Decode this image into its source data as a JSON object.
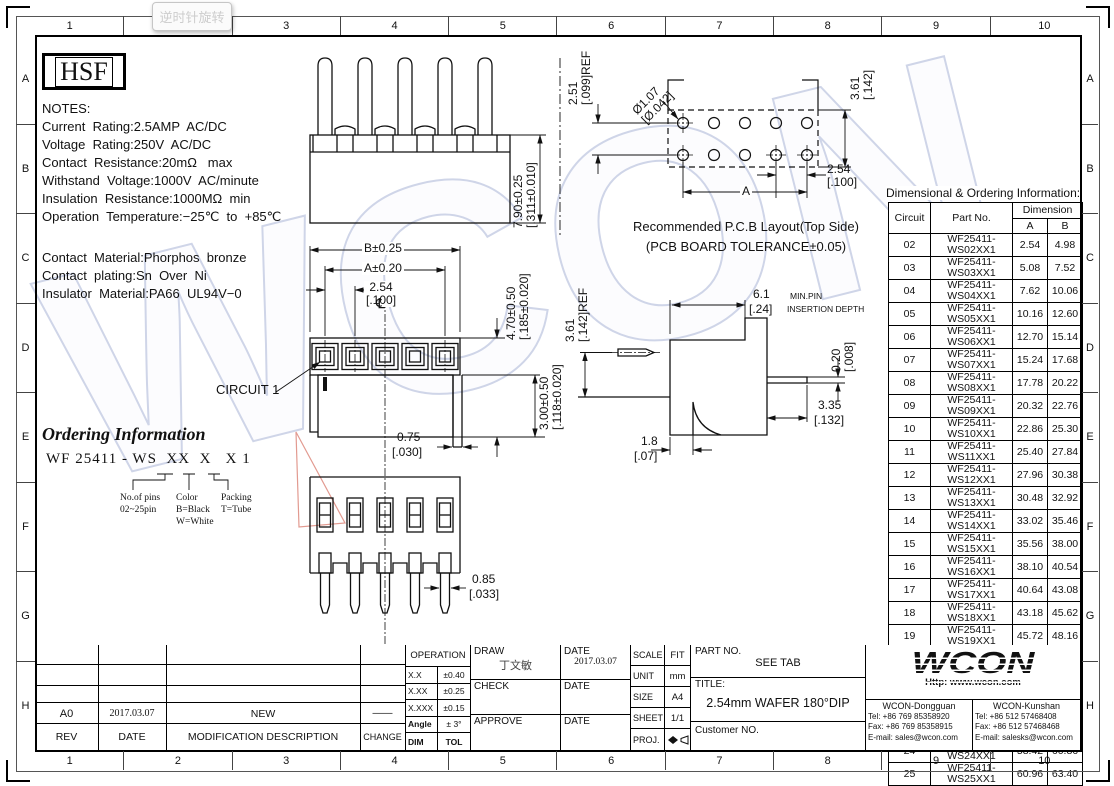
{
  "tooltip": {
    "label": "逆时针旋转"
  },
  "frame": {
    "cols": [
      "1",
      "2",
      "3",
      "4",
      "5",
      "6",
      "7",
      "8",
      "9",
      "10"
    ],
    "rows": [
      "A",
      "B",
      "C",
      "D",
      "E",
      "F",
      "G",
      "H"
    ]
  },
  "logo": {
    "text": "HSF"
  },
  "notes": {
    "lines": [
      "NOTES:",
      "Current  Rating:2.5AMP  AC/DC",
      "Voltage  Rating:250V  AC/DC",
      "Contact  Resistance:20mΩ   max",
      "Withstand  Voltage:1000V  AC/minute",
      "Insulation  Resistance:1000MΩ  min",
      "Operation  Temperature:−25℃  to  +85℃"
    ]
  },
  "materials": {
    "lines": [
      "Contact  Material:Phorphos  bronze",
      "Contact  plating:Sn  Over  Ni",
      "Insulator  Material:PA66  UL94V−0"
    ]
  },
  "ordering": {
    "title": "Ordering Information",
    "code": "WF 25411 - WS  XX  X   X 1",
    "legend1": [
      "No.of pins",
      "02~25pin"
    ],
    "legend2": [
      "Color",
      "B=Black",
      "W=White"
    ],
    "legend3": [
      "Packing",
      "T=Tube"
    ]
  },
  "views": {
    "front_top": {
      "dim": [
        "7.90±0.25",
        "[.311±0.010]"
      ]
    },
    "pcb": {
      "row_pitch": [
        "2.51",
        "[.099]REF"
      ],
      "hole_dia": [
        "Ø1.07",
        "[Ø.042]"
      ],
      "edge": [
        "3.61",
        "[.142]"
      ],
      "pitch": [
        "2.54",
        "[.100]"
      ],
      "span": "A",
      "caption1": "Recommended  P.C.B  Layout(Top  Side)",
      "caption2": "(PCB  BOARD  TOLERANCE±0.05)"
    },
    "front": {
      "dim_b": "B±0.25",
      "dim_a": "A±0.20",
      "pitch": [
        "2.54",
        "[.100]"
      ],
      "centerline": "℄",
      "circuit": "CIRCUIT  1",
      "height1": [
        "4.70±0.50",
        "[.185±0.020]"
      ],
      "height2": [
        "3.00±0.50",
        "[.118±0.020]"
      ]
    },
    "side": {
      "pin_h": [
        "3.61",
        "[.142]REF"
      ],
      "depth": [
        "6.1",
        "[.24]"
      ],
      "depth_note1": "MIN.PIN",
      "depth_note2": "INSERTION  DEPTH",
      "tail_t": [
        "0.20",
        "[.008]"
      ],
      "tail_l": [
        "3.35",
        "[.132]"
      ],
      "standoff": [
        "1.8",
        "[.07]"
      ]
    },
    "bottom": {
      "tail_w": [
        "0.75",
        "[.030]"
      ],
      "pin_w": [
        "0.85",
        "[.033]"
      ]
    }
  },
  "table": {
    "title": "Dimensional  &  Ordering  Information:",
    "col_circuit": "Circuit",
    "col_part": "Part  No.",
    "col_dim": "Dimension",
    "col_a": "A",
    "col_b": "B",
    "rows": [
      [
        "02",
        "WF25411-WS02XX1",
        "2.54",
        "4.98"
      ],
      [
        "03",
        "WF25411-WS03XX1",
        "5.08",
        "7.52"
      ],
      [
        "04",
        "WF25411-WS04XX1",
        "7.62",
        "10.06"
      ],
      [
        "05",
        "WF25411-WS05XX1",
        "10.16",
        "12.60"
      ],
      [
        "06",
        "WF25411-WS06XX1",
        "12.70",
        "15.14"
      ],
      [
        "07",
        "WF25411-WS07XX1",
        "15.24",
        "17.68"
      ],
      [
        "08",
        "WF25411-WS08XX1",
        "17.78",
        "20.22"
      ],
      [
        "09",
        "WF25411-WS09XX1",
        "20.32",
        "22.76"
      ],
      [
        "10",
        "WF25411-WS10XX1",
        "22.86",
        "25.30"
      ],
      [
        "11",
        "WF25411-WS11XX1",
        "25.40",
        "27.84"
      ],
      [
        "12",
        "WF25411-WS12XX1",
        "27.96",
        "30.38"
      ],
      [
        "13",
        "WF25411-WS13XX1",
        "30.48",
        "32.92"
      ],
      [
        "14",
        "WF25411-WS14XX1",
        "33.02",
        "35.46"
      ],
      [
        "15",
        "WF25411-WS15XX1",
        "35.56",
        "38.00"
      ],
      [
        "16",
        "WF25411-WS16XX1",
        "38.10",
        "40.54"
      ],
      [
        "17",
        "WF25411-WS17XX1",
        "40.64",
        "43.08"
      ],
      [
        "18",
        "WF25411-WS18XX1",
        "43.18",
        "45.62"
      ],
      [
        "19",
        "WF25411-WS19XX1",
        "45.72",
        "48.16"
      ],
      [
        "20",
        "WF25411-WS20XX1",
        "48.26",
        "50.70"
      ],
      [
        "21",
        "WF25411-WS21XX1",
        "50.80",
        "53.24"
      ],
      [
        "22",
        "WF25411-WS22XX1",
        "53.34",
        "55.78"
      ],
      [
        "23",
        "WF25411-WS23XX1",
        "55.88",
        "58.32"
      ],
      [
        "24",
        "WF25411-WS24XX1",
        "58.42",
        "60.86"
      ],
      [
        "25",
        "WF25411-WS25XX1",
        "60.96",
        "63.40"
      ]
    ]
  },
  "titleblock": {
    "rev_header": {
      "rev": "REV",
      "date": "DATE",
      "desc": "MODIFICATION  DESCRIPTION",
      "change": "CHANGE"
    },
    "rev_row": {
      "rev": "A0",
      "date": "2017.03.07",
      "desc": "NEW",
      "change": "——"
    },
    "operation": {
      "title": "OPERATION",
      "r1l": "X.X",
      "r1v": "±0.40",
      "r2l": "X.XX",
      "r2v": "±0.25",
      "r3l": "X.XXX",
      "r3v": "±0.15",
      "r4l": "Angle",
      "r4v": "± 3°",
      "f1": "DIM",
      "f2": "TOL"
    },
    "sign": {
      "draw_label": "DRAW",
      "draw_name": "丁文敏",
      "draw_date_label": "DATE",
      "draw_date": "2017.03.07",
      "check_label": "CHECK",
      "check_date_label": "DATE",
      "approve_label": "APPROVE",
      "approve_date_label": "DATE"
    },
    "meta": {
      "scale_label": "SCALE",
      "scale": "FIT",
      "unit_label": "UNIT",
      "unit": "mm",
      "size_label": "SIZE",
      "size": "A4",
      "sheet_label": "SHEET",
      "sheet": "1/1",
      "proj_label": "PROJ."
    },
    "part": {
      "part_no_label": "PART  NO.",
      "part_no": "SEE  TAB",
      "title_label": "TITLE:",
      "title": "2.54mm  WAFER  180°DIP",
      "customer": "Customer  NO."
    },
    "wcon": {
      "logo": "WCON",
      "url": "Http:  www.wcon.com",
      "dongguan": {
        "name": "WCON-Dongguan",
        "tel": "Tel: +86 769 85358920",
        "fax": "Fax: +86 769 85358915",
        "email": "E-mail: sales@wcon.com"
      },
      "kunshan": {
        "name": "WCON-Kunshan",
        "tel": "Tel: +86 512 57468408",
        "fax": "Fax: +86 512 57468468",
        "email": "E-mail: salesks@wcon.com"
      }
    }
  },
  "watermark": {
    "text": "WCON",
    "outline_color": "#cfd5e8",
    "accent_color": "#e29a90"
  }
}
